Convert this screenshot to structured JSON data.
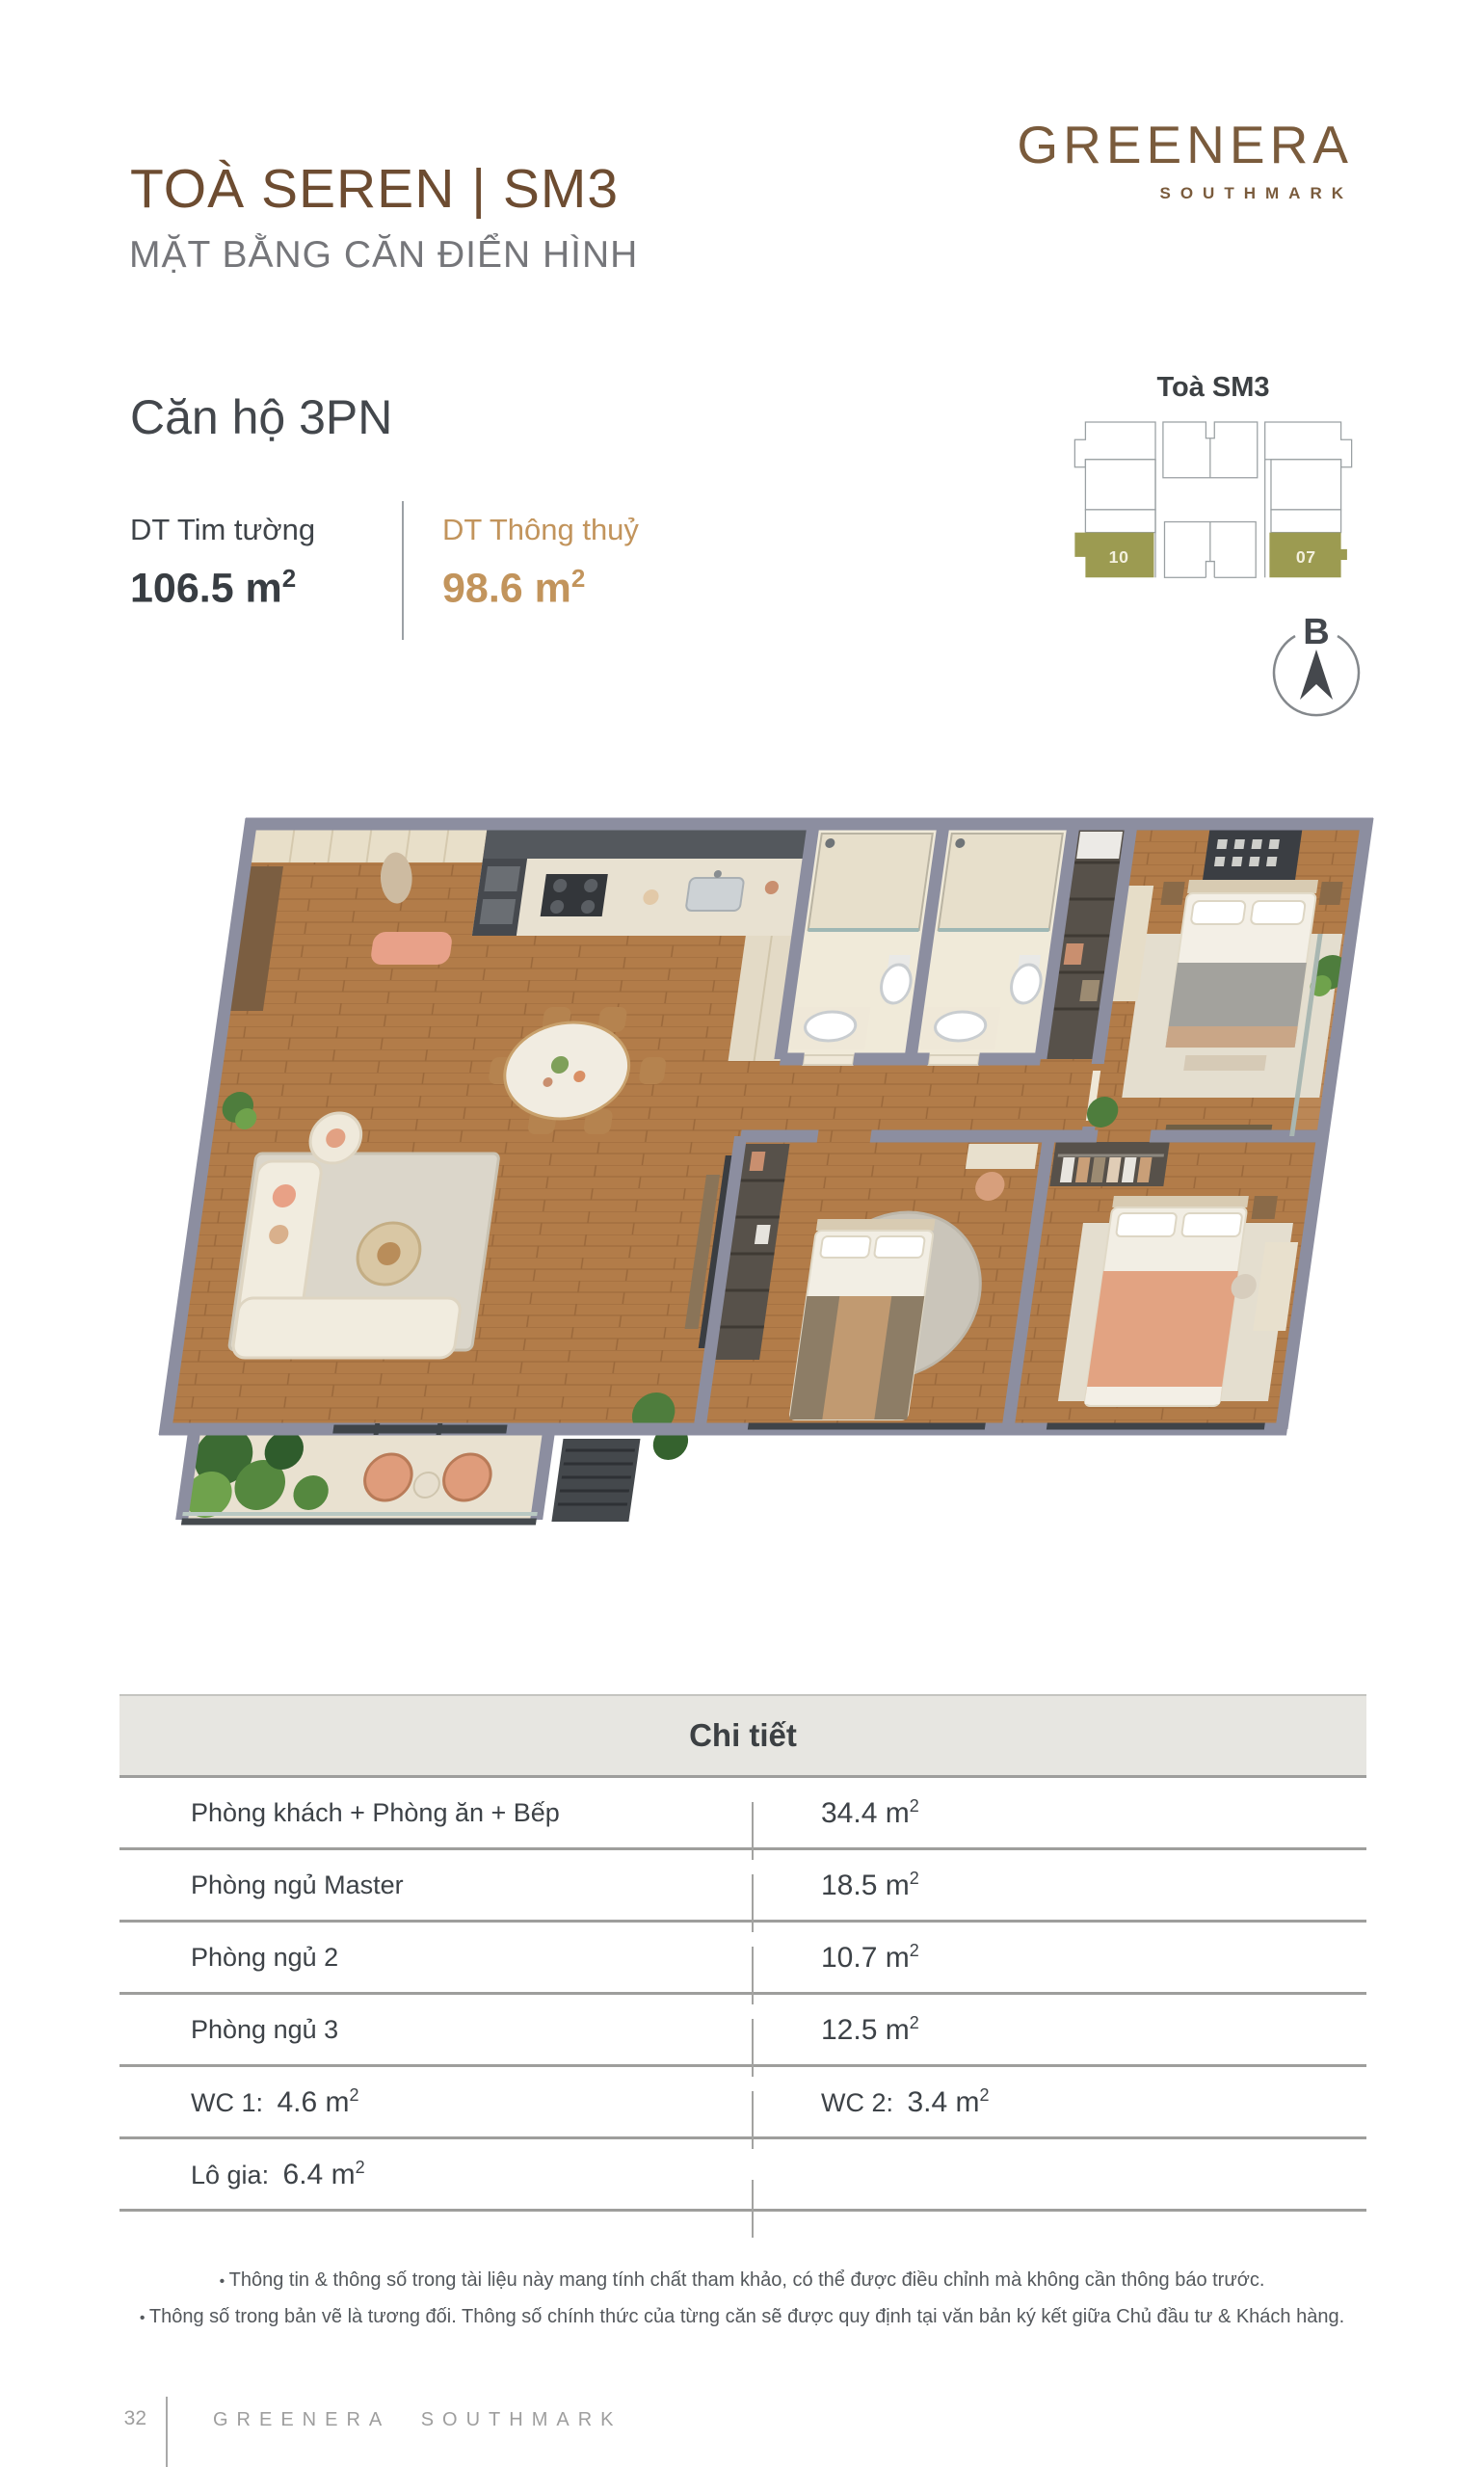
{
  "header": {
    "title": "TOÀ SEREN | SM3",
    "subtitle": "MẶT BẰNG CĂN ĐIỂN HÌNH"
  },
  "logo": {
    "name": "GREENERA",
    "sub": "SOUTHMARK"
  },
  "apartment": {
    "type": "Căn hộ 3PN",
    "area_left": {
      "label": "DT Tim tường",
      "value": "106.5 m",
      "sup": "2"
    },
    "area_right": {
      "label": "DT Thông thuỷ",
      "value": "98.6 m",
      "sup": "2"
    }
  },
  "key_plan": {
    "title": "Toà SM3",
    "unit_left": "10",
    "unit_right": "07",
    "compass_letter": "B"
  },
  "detail_table": {
    "header": "Chi tiết",
    "rows": [
      {
        "left_label": "Phòng khách + Phòng ăn + Bếp",
        "right_value": "34.4 m",
        "right_sup": "2"
      },
      {
        "left_label": "Phòng ngủ Master",
        "right_value": "18.5 m",
        "right_sup": "2"
      },
      {
        "left_label": "Phòng ngủ 2",
        "right_value": "10.7 m",
        "right_sup": "2"
      },
      {
        "left_label": "Phòng ngủ 3",
        "right_value": "12.5 m",
        "right_sup": "2"
      },
      {
        "left_label": "WC 1:",
        "left_value": "4.6 m",
        "left_sup": "2",
        "right_label": "WC 2:",
        "right_value": "3.4 m",
        "right_sup": "2"
      },
      {
        "left_label": "Lô gia:",
        "left_value": "6.4 m",
        "left_sup": "2"
      }
    ]
  },
  "notes": {
    "line1": "Thông tin & thông số trong tài liệu này mang tính chất tham khảo, có thể được điều chỉnh mà không cần thông báo trước.",
    "line2": "Thông số trong bản vẽ là tương đối. Thông số chính thức của từng căn sẽ được quy định tại văn bản ký kết giữa Chủ đầu tư & Khách hàng."
  },
  "footer": {
    "page_number": "32",
    "brand": "GREENERA SOUTHMARK"
  },
  "colors": {
    "brand_brown": "#6d4c31",
    "logo_brown": "#7a5b3c",
    "accent_gold": "#c2945c",
    "olive_highlight": "#9c9b51",
    "dark_text": "#3d4248",
    "muted_gray": "#75767a",
    "table_border": "#9e9e9c",
    "wall_gray": "#8c8ea0",
    "wood_floor": "#b27c49"
  }
}
